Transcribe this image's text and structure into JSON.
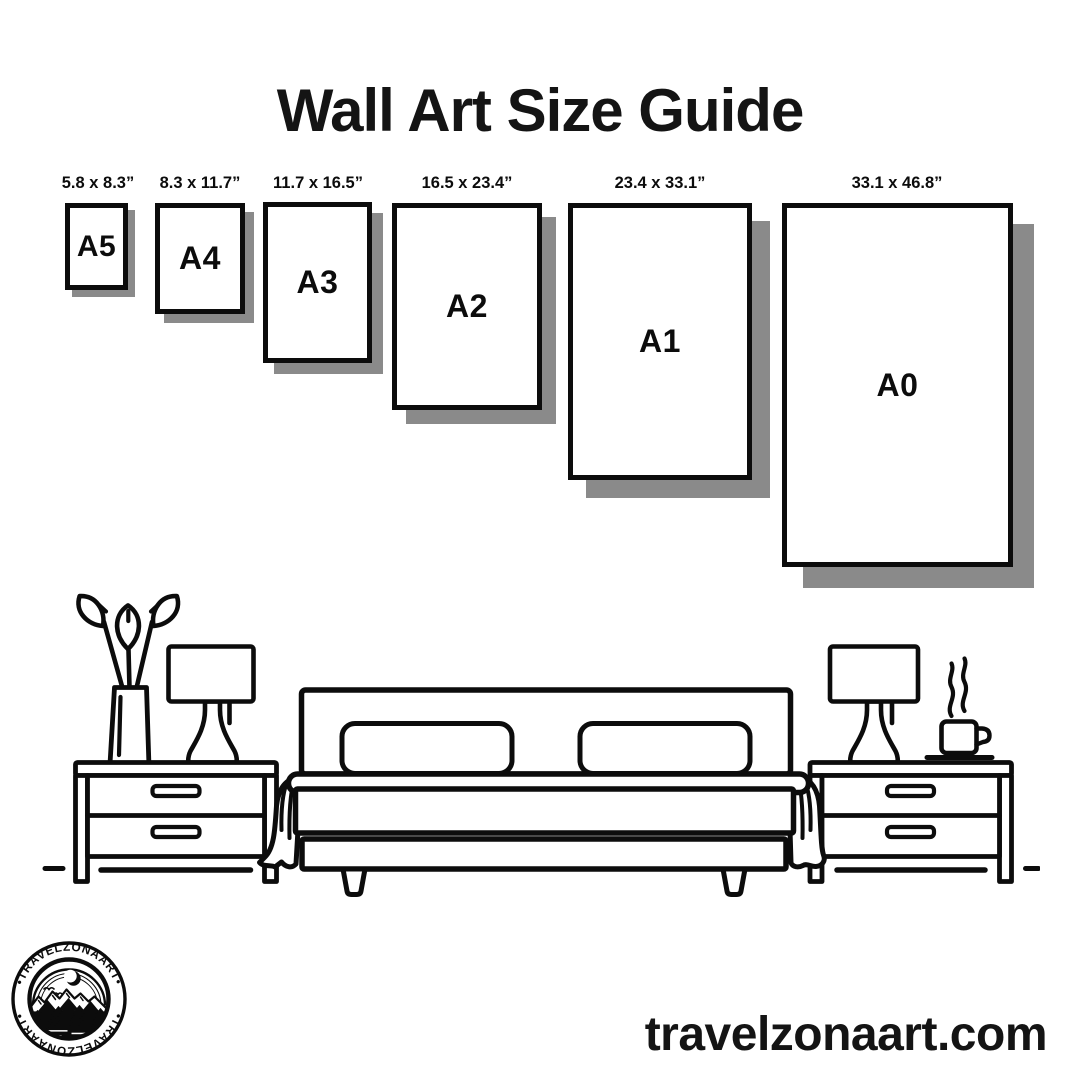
{
  "title": "Wall Art Size Guide",
  "size_guide": {
    "sizes": [
      {
        "code": "A5",
        "dimensions_label": "5.8 x 8.3”"
      },
      {
        "code": "A4",
        "dimensions_label": "8.3 x 11.7”"
      },
      {
        "code": "A3",
        "dimensions_label": "11.7 x 16.5”"
      },
      {
        "code": "A2",
        "dimensions_label": "16.5 x 23.4”"
      },
      {
        "code": "A1",
        "dimensions_label": "23.4 x 33.1”"
      },
      {
        "code": "A0",
        "dimensions_label": "33.1 x 46.8”"
      }
    ]
  },
  "illustration": {
    "scene": "bedroom-line-art",
    "objects": [
      "flower-vase",
      "table-lamp",
      "nightstand",
      "double-bed-with-pillows",
      "table-lamp",
      "coffee-cup-with-steam",
      "nightstand"
    ]
  },
  "logo": {
    "badge_text_top": "•TRAVELZONAART•",
    "badge_text_bottom": "•TRAVELZONAART•"
  },
  "footer": {
    "website": "travelzonaart.com"
  },
  "colors": {
    "ink": "#0c0c0c",
    "shadow": "#8a8a8a",
    "background": "#ffffff"
  }
}
